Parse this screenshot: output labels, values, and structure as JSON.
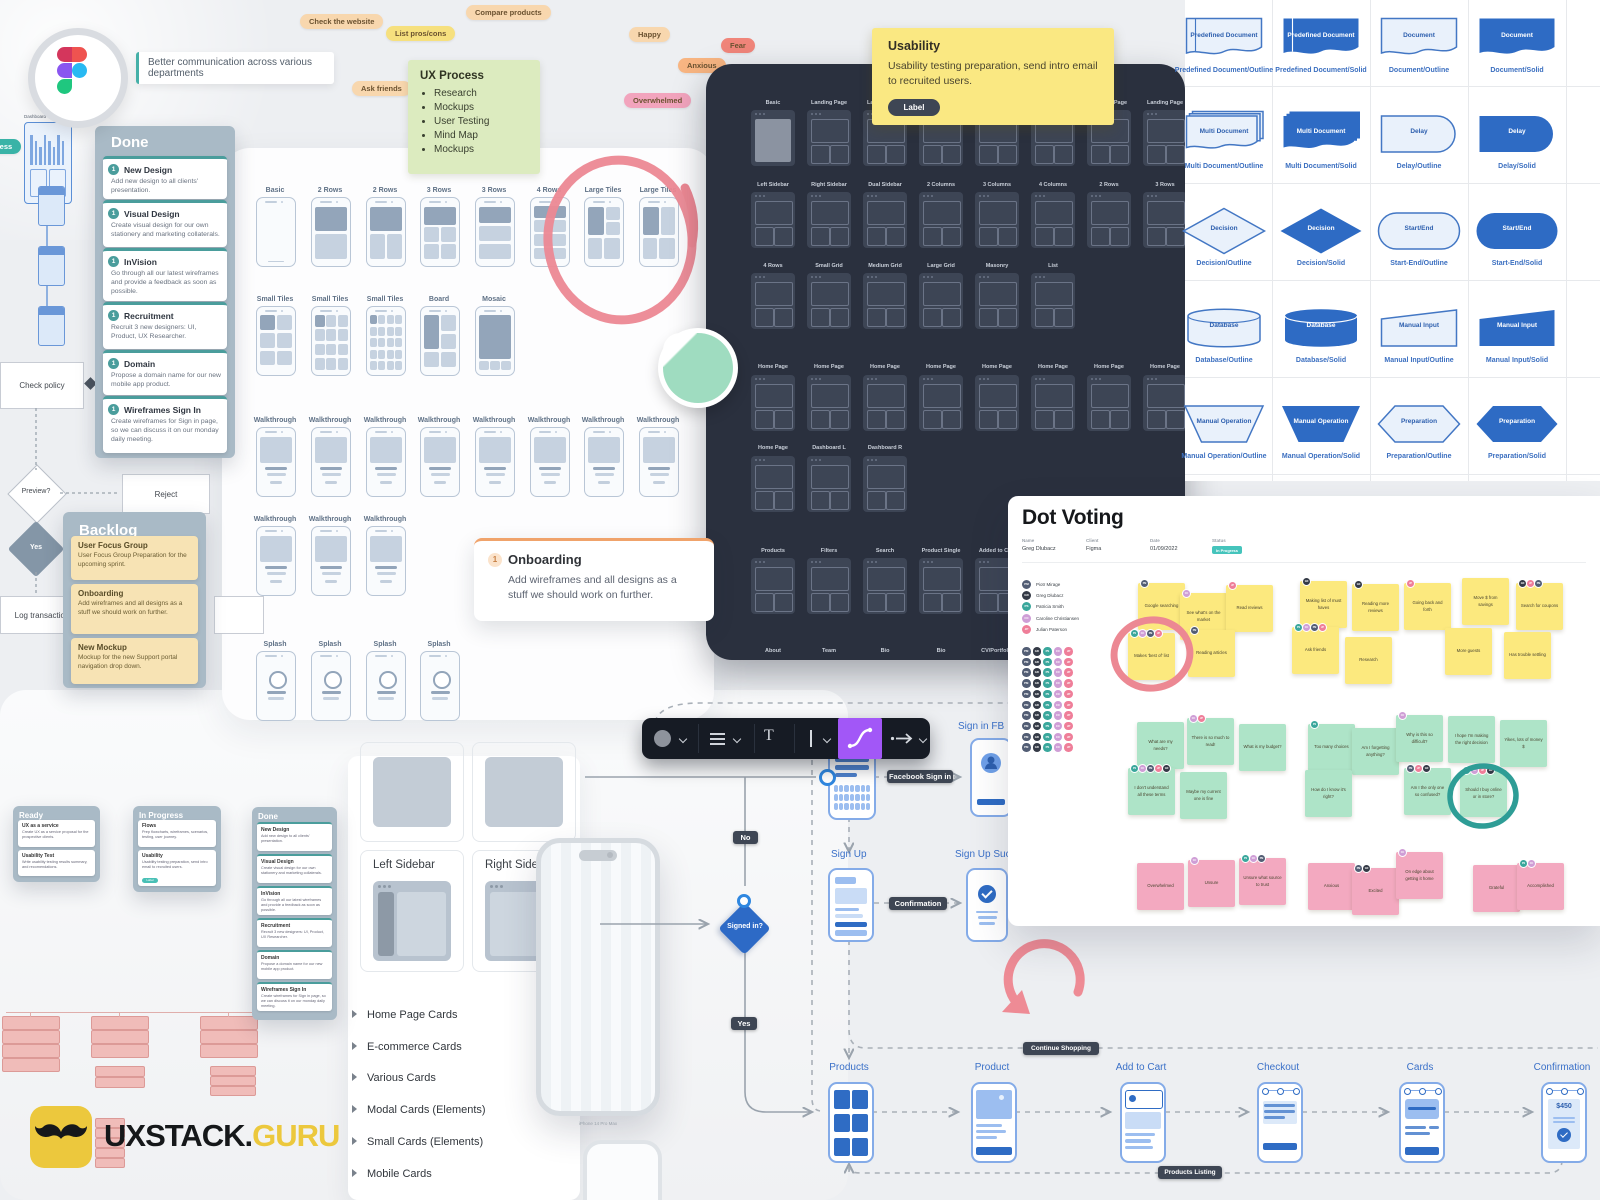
{
  "logo": {
    "brand_black": "UXSTACK.",
    "brand_yellow": "GURU"
  },
  "figma_note": "Better communication across various departments",
  "tags": [
    {
      "id": "check-website",
      "text": "Check the website",
      "color": "peach"
    },
    {
      "id": "list-pros-cons",
      "text": "List pros/cons",
      "color": "yellow"
    },
    {
      "id": "compare-products",
      "text": "Compare products",
      "color": "peach"
    },
    {
      "id": "happy",
      "text": "Happy",
      "color": "peach"
    },
    {
      "id": "ask-friends",
      "text": "Ask friends",
      "color": "peach"
    },
    {
      "id": "fear",
      "text": "Fear",
      "color": "red"
    },
    {
      "id": "anxious",
      "text": "Anxious",
      "color": "orange"
    },
    {
      "id": "overwhelmed",
      "text": "Overwhelmed",
      "color": "pink"
    },
    {
      "id": "process",
      "text": "Process",
      "color": "teal"
    }
  ],
  "ux_process": {
    "title": "UX Process",
    "items": [
      "Research",
      "Mockups",
      "User Testing",
      "Mind Map",
      "Mockups"
    ]
  },
  "done_column": {
    "title": "Done",
    "cards": [
      {
        "num": "1",
        "title": "New Design",
        "body": "Add new design to all clients' presentation."
      },
      {
        "num": "1",
        "title": "Visual Design",
        "body": "Create visual design for our own stationery and marketing collaterals."
      },
      {
        "num": "1",
        "title": "InVision",
        "body": "Go through all our latest wireframes and provide a feedback as soon as possible."
      },
      {
        "num": "1",
        "title": "Recruitment",
        "body": "Recruit 3 new designers: UI, Product, UX Researcher."
      },
      {
        "num": "1",
        "title": "Domain",
        "body": "Propose a domain name for our new mobile app product."
      },
      {
        "num": "1",
        "title": "Wireframes Sign In",
        "body": "Create wireframes for Sign in page, so we can discuss it on our monday daily meeting."
      }
    ]
  },
  "backlog_column": {
    "title": "Backlog",
    "cards": [
      {
        "title": "User Focus Group",
        "body": "User Focus Group Preparation for the upcoming sprint."
      },
      {
        "title": "Onboarding",
        "body": "Add wireframes and all designs as a stuff we should work on further."
      },
      {
        "title": "New Mockup",
        "body": "Mockup for the new Support portal navigation drop down."
      }
    ]
  },
  "onboarding_note": {
    "num": "1",
    "title": "Onboarding",
    "body": "Add wireframes and all designs as a stuff we should work on further."
  },
  "usability_note": {
    "title": "Usability",
    "body": "Usability testing preparation, send intro email to recruited users.",
    "label": "Label"
  },
  "light_grid": {
    "rows": [
      [
        "Basic",
        "2 Rows",
        "2 Rows",
        "3 Rows",
        "3 Rows",
        "4 Rows",
        "Large Tiles",
        "Large Tiles"
      ],
      [
        "Small Tiles",
        "Small Tiles",
        "Small Tiles",
        "Board",
        "Mosaic"
      ],
      [
        "Walkthrough",
        "Walkthrough",
        "Walkthrough",
        "Walkthrough",
        "Walkthrough",
        "Walkthrough",
        "Walkthrough",
        "Walkthrough"
      ],
      [
        "Walkthrough",
        "Walkthrough",
        "Walkthrough"
      ],
      [
        "Splash",
        "Splash",
        "Splash",
        "Splash"
      ]
    ]
  },
  "dark_grid": {
    "rows": [
      [
        "Basic",
        "Landing Page",
        "Landing Page",
        "Landing Page",
        "Landing Page",
        "Landing Page",
        "Landing Page",
        "Landing Page"
      ],
      [
        "Left Sidebar",
        "Right Sidebar",
        "Dual Sidebar",
        "2 Columns",
        "3 Columns",
        "4 Columns",
        "2 Rows",
        "3 Rows"
      ],
      [
        "4 Rows",
        "Small Grid",
        "Medium Grid",
        "Large Grid",
        "Masonry",
        "List"
      ],
      [
        "Home Page",
        "Home Page",
        "Home Page",
        "Home Page",
        "Home Page",
        "Home Page",
        "Home Page",
        "Home Page"
      ],
      [
        "Home Page",
        "Dashboard L",
        "Dashboard R"
      ],
      [
        "Products",
        "Filters",
        "Search",
        "Product Single",
        "Added to Cart"
      ],
      [
        "About",
        "Team",
        "Bio",
        "Bio",
        "CV/Portfolio"
      ]
    ]
  },
  "shapes": [
    {
      "shape": "predefined",
      "variant": "outline",
      "label": "Predefined Document",
      "caption": "Predefined Document/Outline"
    },
    {
      "shape": "predefined",
      "variant": "solid",
      "label": "Predefined Document",
      "caption": "Predefined Document/Solid"
    },
    {
      "shape": "document",
      "variant": "outline",
      "label": "Document",
      "caption": "Document/Outline"
    },
    {
      "shape": "document",
      "variant": "solid",
      "label": "Document",
      "caption": "Document/Solid"
    },
    {
      "shape": "multidoc",
      "variant": "outline",
      "label": "Multi Document",
      "caption": "Multi Document/Outline"
    },
    {
      "shape": "multidoc",
      "variant": "solid",
      "label": "Multi Document",
      "caption": "Multi Document/Solid"
    },
    {
      "shape": "delay",
      "variant": "outline",
      "label": "Delay",
      "caption": "Delay/Outline"
    },
    {
      "shape": "delay",
      "variant": "solid",
      "label": "Delay",
      "caption": "Delay/Solid"
    },
    {
      "shape": "decision",
      "variant": "outline",
      "label": "Decision",
      "caption": "Decision/Outline"
    },
    {
      "shape": "decision",
      "variant": "solid",
      "label": "Decision",
      "caption": "Decision/Solid"
    },
    {
      "shape": "startend",
      "variant": "outline",
      "label": "Start/End",
      "caption": "Start-End/Outline"
    },
    {
      "shape": "startend",
      "variant": "solid",
      "label": "Start/End",
      "caption": "Start-End/Solid"
    },
    {
      "shape": "database",
      "variant": "outline",
      "label": "Database",
      "caption": "Database/Outline"
    },
    {
      "shape": "database",
      "variant": "solid",
      "label": "Database",
      "caption": "Database/Solid"
    },
    {
      "shape": "maninput",
      "variant": "outline",
      "label": "Manual Input",
      "caption": "Manual Input/Outline"
    },
    {
      "shape": "maninput",
      "variant": "solid",
      "label": "Manual Input",
      "caption": "Manual Input/Solid"
    },
    {
      "shape": "manop",
      "variant": "outline",
      "label": "Manual Operation",
      "caption": "Manual Operation/Outline"
    },
    {
      "shape": "manop",
      "variant": "solid",
      "label": "Manual Operation",
      "caption": "Manual Operation/Solid"
    },
    {
      "shape": "preparation",
      "variant": "outline",
      "label": "Preparation",
      "caption": "Preparation/Outline"
    },
    {
      "shape": "preparation",
      "variant": "solid",
      "label": "Preparation",
      "caption": "Preparation/Solid"
    }
  ],
  "dot_voting": {
    "title": "Dot Voting",
    "meta": [
      {
        "label": "Name",
        "value": "Greg Dlubacz"
      },
      {
        "label": "Client",
        "value": "Figma"
      },
      {
        "label": "Date",
        "value": "01/09/2022"
      },
      {
        "label": "Status",
        "value": "In Progress"
      }
    ],
    "participants": [
      {
        "initials": "PM",
        "name": "Piotr Mirage",
        "color": "navy"
      },
      {
        "initials": "GD",
        "name": "Greg Dlubacz",
        "color": "black"
      },
      {
        "initials": "PS",
        "name": "Patricia Smith",
        "color": "teal"
      },
      {
        "initials": "CC",
        "name": "Caroline Christiansen",
        "color": "lilac"
      },
      {
        "initials": "JP",
        "name": "Julian Paterson",
        "color": "pink"
      }
    ],
    "avatar_colors": {
      "navy": "#525d74",
      "black": "#343a46",
      "teal": "#3aa79c",
      "lilac": "#cf9ed6",
      "pink": "#ef7e99"
    },
    "notes_yellow": [
      {
        "text": "Google searching",
        "dots": [
          "navy"
        ]
      },
      {
        "text": "See what's on the market",
        "dots": [
          "lilac"
        ]
      },
      {
        "text": "Read reviews",
        "dots": [
          "pink"
        ]
      },
      {
        "text": "Makes 'best of' list",
        "dots": [
          "teal",
          "lilac",
          "navy",
          "pink"
        ]
      },
      {
        "text": "Reading articles",
        "dots": [
          "navy"
        ]
      },
      {
        "text": "Making list of must haves",
        "dots": [
          "black"
        ]
      },
      {
        "text": "Reading more reviews",
        "dots": [
          "black"
        ]
      },
      {
        "text": "Going back and forth",
        "dots": [
          "pink"
        ]
      },
      {
        "text": "Ask friends",
        "dots": [
          "teal",
          "lilac",
          "navy",
          "pink"
        ]
      },
      {
        "text": "Research",
        "dots": []
      },
      {
        "text": "Move $ from savings",
        "dots": []
      },
      {
        "text": "Search for coupons",
        "dots": [
          "black",
          "pink",
          "navy"
        ]
      },
      {
        "text": "More guests",
        "dots": []
      },
      {
        "text": "Has trouble settling",
        "dots": []
      }
    ],
    "notes_green": [
      {
        "text": "What are my needs?",
        "dots": []
      },
      {
        "text": "There is so much to read!",
        "dots": [
          "lilac",
          "pink"
        ]
      },
      {
        "text": "What is my budget?",
        "dots": []
      },
      {
        "text": "I don't understand all these terms",
        "dots": [
          "teal",
          "lilac",
          "navy",
          "pink",
          "black"
        ]
      },
      {
        "text": "Maybe my current one is fine",
        "dots": []
      },
      {
        "text": "Too many choices",
        "dots": [
          "teal"
        ]
      },
      {
        "text": "Am I forgetting anything?",
        "dots": []
      },
      {
        "text": "Why is this so difficult?",
        "dots": [
          "lilac"
        ]
      },
      {
        "text": "How do I know it's right?",
        "dots": []
      },
      {
        "text": "Am I the only one so confused?",
        "dots": [
          "navy",
          "pink",
          "black"
        ]
      },
      {
        "text": "I hope I'm making the right decision",
        "dots": []
      },
      {
        "text": "Yikes, lots of money $",
        "dots": []
      },
      {
        "text": "Should I buy online or in store?",
        "dots": [
          "teal",
          "lilac",
          "pink",
          "black"
        ]
      }
    ],
    "notes_pink": [
      {
        "text": "Overwhelmed",
        "dots": []
      },
      {
        "text": "Unsure",
        "dots": [
          "lilac"
        ]
      },
      {
        "text": "Unsure what source to trust",
        "dots": [
          "teal",
          "lilac",
          "navy"
        ]
      },
      {
        "text": "Anxious",
        "dots": []
      },
      {
        "text": "Excited",
        "dots": [
          "navy",
          "black"
        ]
      },
      {
        "text": "On edge about getting it home",
        "dots": [
          "lilac"
        ]
      },
      {
        "text": "Grateful",
        "dots": []
      },
      {
        "text": "Accomplished",
        "dots": [
          "teal",
          "lilac"
        ]
      }
    ]
  },
  "left_flow": {
    "check_policy": "Check policy",
    "preview": "Preview?",
    "reject": "Reject",
    "yes": "Yes",
    "log_transaction": "Log transaction"
  },
  "mini_kanban": {
    "ready": {
      "title": "Ready",
      "cards": [
        {
          "title": "UX as a service",
          "body": "Create UX as a service proposal for the prospective clients."
        },
        {
          "title": "Usability Test",
          "body": "Write usability testing results summary, and recomendations."
        }
      ]
    },
    "in_progress": {
      "title": "In Progress",
      "cards": [
        {
          "title": "Flows",
          "body": "Prep flowcharts, wireframes, scenarios, testing, user journey."
        },
        {
          "title": "Usability",
          "body": "Usability testing preparation, send intro email to recruited users.",
          "label": "Label"
        }
      ]
    },
    "done_title": "Done"
  },
  "cards_menu": [
    "Home Page Cards",
    "E-commerce Cards",
    "Various Cards",
    "Modal Cards (Elements)",
    "Small Cards (Elements)",
    "Mobile Cards"
  ],
  "sidebar_cells": {
    "left": "Left Sidebar",
    "right": "Right Sidebar"
  },
  "phone_caption": "iPhone 14 Pro Max",
  "flow": {
    "no": "No",
    "yes": "Yes",
    "signed_in": "Signed in?",
    "facebook": "Facebook Sign in",
    "confirmation": "Confirmation",
    "sign_in_fb": "Sign in FB",
    "sign_up": "Sign Up",
    "sign_up_success": "Sign Up Success",
    "continue_shopping": "Continue Shopping",
    "products_listing": "Products Listing",
    "screens": [
      "Products",
      "Product",
      "Add to Cart",
      "Checkout",
      "Cards",
      "Confirmation"
    ],
    "price": "$450"
  },
  "mini_dashboard_label": "Dashboard"
}
